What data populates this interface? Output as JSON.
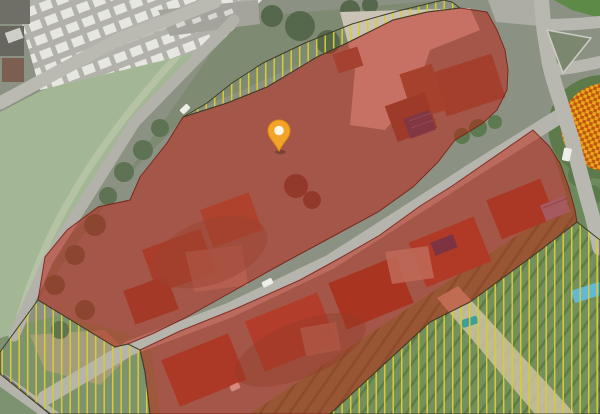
{
  "map": {
    "kind": "aerial-satellite-parcel-map",
    "palette": {
      "parcel_red_fill": "#c21507",
      "parcel_red_opacity": "0.47",
      "parcel_red_stroke": "#70110a",
      "hatch_line": "#d8cc2e",
      "hatch_outline": "#3e3e28",
      "checker_orange_light": "#e6a71a",
      "checker_orange_dark": "#c35511",
      "pin_fill": "#f4a329",
      "pin_stroke": "#e08f12",
      "pin_inner": "#fff6e4"
    },
    "marker": {
      "name": "location-pin",
      "x": 279,
      "y": 132
    },
    "zones": [
      {
        "name": "red-parcel-north",
        "kind": "red",
        "points": "38,300 45,257 67,230 98,207 130,200 140,177 167,143 183,117 227,103 267,87 317,57 347,43 393,20 427,12 460,8 487,12 497,30 505,50 508,70 507,90 497,110 483,123 467,133 455,140 438,162 413,187 378,212 328,239 278,266 228,294 185,318 152,334 128,344 115,347"
      },
      {
        "name": "red-parcel-south",
        "kind": "red",
        "points": "140,350 180,331 235,309 300,280 340,258 380,235 420,206 452,186 533,130 549,146 560,163 569,188 575,210 577,222 530,258 470,302 430,322 330,414 150,414 145,372"
      },
      {
        "name": "hatched-strip-north",
        "kind": "hatch",
        "points": "443,0 398,11 352,24 305,43 263,63 232,83 207,103 190,113 183,117 227,103 267,87 317,57 347,43 393,20 427,12 460,8 452,2"
      },
      {
        "name": "hatched-area-southwest",
        "kind": "hatch",
        "points": "38,300 115,347 128,344 140,350 145,372 150,414 50,414 0,374 0,352"
      },
      {
        "name": "hatched-area-southeast",
        "kind": "hatch",
        "points": "330,414 430,322 470,302 530,258 577,222 600,240 600,414"
      }
    ]
  }
}
